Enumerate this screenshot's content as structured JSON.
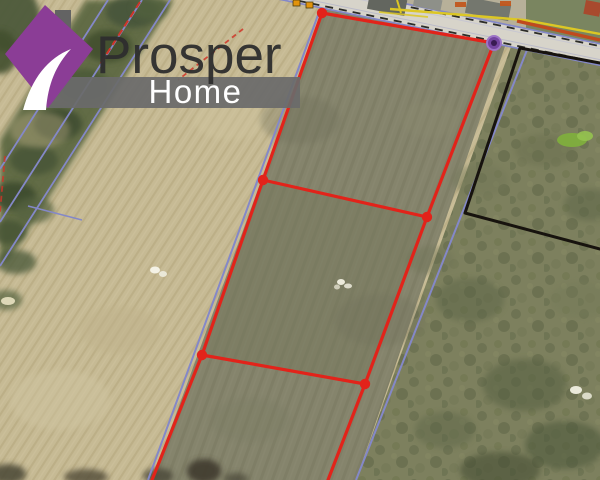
{
  "branding": {
    "title": "Prosper",
    "subtitle": "Home",
    "colors": {
      "icon_purple": "#8b3d96",
      "icon_chimney_gray": "#636363",
      "icon_swoosh_white": "#ffffff",
      "banner_gray": "#6a6a6a",
      "title_text": "#2e2e2e",
      "subtitle_text": "#ffffff"
    }
  },
  "map": {
    "type": "aerial-parcel-map",
    "palette": {
      "field_tan": "#c6ba94",
      "parcel_olive": "#85846c",
      "scrub_green": "#7d805e",
      "hedge_green": "#5a6641",
      "road_gray": "#d7d4ca",
      "cadastral_blue": "#8488c8",
      "parcel_red": "#e2231a",
      "parcel_black": "#17130e",
      "marker_orange": "#e2930c",
      "label_orange": "#c1571d",
      "line_yellow": "#dcc724",
      "line_orange": "#c04a1e",
      "marker_purple": "#7445a0"
    },
    "regions": [
      {
        "n": "base-farm-field",
        "p": [
          [
            0,
            0
          ],
          [
            600,
            0
          ],
          [
            600,
            480
          ],
          [
            0,
            480
          ]
        ],
        "f": "#c6ba94",
        "pat": "plow"
      },
      {
        "n": "listed-parcel-strip",
        "p": [
          [
            327,
            0
          ],
          [
            521,
            0
          ],
          [
            356,
            480
          ],
          [
            152,
            480
          ]
        ],
        "f": "#85846c",
        "pat": "mow"
      },
      {
        "n": "middle-subparcel-tint",
        "p": [
          [
            263,
            180
          ],
          [
            427,
            217
          ],
          [
            365,
            384
          ],
          [
            202,
            355
          ]
        ],
        "f": "#75785c",
        "o": 0.45
      },
      {
        "n": "scrub-field-east",
        "p": [
          [
            512,
            44
          ],
          [
            600,
            61
          ],
          [
            600,
            480
          ],
          [
            356,
            480
          ]
        ],
        "f": "#7d805e",
        "pat": "scrub"
      },
      {
        "n": "north-roadside-yard",
        "p": [
          [
            358,
            0
          ],
          [
            600,
            0
          ],
          [
            600,
            47
          ],
          [
            362,
            1
          ]
        ],
        "f": "#b7b099"
      },
      {
        "n": "north-roadside-grass",
        "p": [
          [
            526,
            0
          ],
          [
            600,
            0
          ],
          [
            600,
            47
          ],
          [
            526,
            33
          ]
        ],
        "f": "#7a8560"
      },
      {
        "n": "hedgerow-band",
        "p": [
          [
            86,
            0
          ],
          [
            174,
            0
          ],
          [
            8,
            262
          ],
          [
            0,
            262
          ],
          [
            0,
            140
          ]
        ],
        "f": "#5a6641",
        "o": 0.92,
        "blur": 1
      }
    ],
    "spots": [
      [
        10,
        18,
        30,
        34,
        "#4d5a3b",
        0.95,
        1
      ],
      [
        0,
        52,
        18,
        22,
        "#43502f",
        0.9,
        1
      ],
      [
        132,
        12,
        26,
        16,
        "#47553a",
        0.9,
        1
      ],
      [
        108,
        46,
        24,
        16,
        "#42502f",
        0.9,
        1
      ],
      [
        84,
        86,
        26,
        17,
        "#4c5a38",
        0.9,
        1
      ],
      [
        58,
        124,
        24,
        16,
        "#3f4d31",
        0.9,
        1
      ],
      [
        34,
        160,
        24,
        15,
        "#485638",
        0.9,
        1
      ],
      [
        14,
        196,
        22,
        14,
        "#3d4b2f",
        0.9,
        1
      ],
      [
        34,
        210,
        20,
        13,
        "#546241",
        0.7,
        1
      ],
      [
        8,
        232,
        18,
        12,
        "#465436",
        0.85,
        1
      ],
      [
        16,
        262,
        20,
        12,
        "#4f5d3d",
        0.8,
        1
      ],
      [
        6,
        300,
        16,
        10,
        "#556341",
        0.7,
        1
      ],
      [
        150,
        8,
        18,
        12,
        "#51603c",
        0.8,
        1
      ],
      [
        60,
        400,
        50,
        30,
        "#cfc4a0",
        0.5,
        1
      ],
      [
        120,
        330,
        40,
        24,
        "#bfb28b",
        0.5,
        1
      ],
      [
        230,
        120,
        36,
        20,
        "#cfc49e",
        0.45,
        1
      ],
      [
        40,
        130,
        30,
        18,
        "#b9ac84",
        0.4,
        1
      ],
      [
        300,
        120,
        40,
        24,
        "#6f705a",
        0.35,
        1
      ],
      [
        380,
        320,
        46,
        26,
        "#6f705a",
        0.3,
        1
      ],
      [
        250,
        420,
        40,
        22,
        "#7a7b63",
        0.35,
        1
      ],
      [
        430,
        120,
        30,
        18,
        "#8b8a70",
        0.35,
        1
      ],
      [
        470,
        300,
        34,
        22,
        "#5c6547",
        0.5,
        1
      ],
      [
        525,
        385,
        42,
        26,
        "#566042",
        0.55,
        1
      ],
      [
        565,
        445,
        40,
        24,
        "#4f5a3d",
        0.6,
        1
      ],
      [
        590,
        205,
        26,
        16,
        "#5c6547",
        0.5,
        1
      ],
      [
        445,
        430,
        30,
        18,
        "#5c6547",
        0.45,
        1
      ],
      [
        545,
        150,
        30,
        16,
        "#6a7050",
        0.5,
        1
      ],
      [
        480,
        180,
        28,
        16,
        "#717656",
        0.45,
        1
      ],
      [
        430,
        260,
        24,
        14,
        "#6d7254",
        0.4,
        1
      ],
      [
        580,
        300,
        30,
        18,
        "#757a58",
        0.45,
        1
      ],
      [
        500,
        470,
        40,
        18,
        "#474f35",
        0.6,
        1
      ],
      [
        8,
        474,
        18,
        10,
        "#4a4636",
        0.85,
        1
      ],
      [
        86,
        477,
        22,
        8,
        "#514b38",
        0.8,
        1
      ],
      [
        158,
        476,
        15,
        8,
        "#4a4637",
        0.8,
        1
      ],
      [
        204,
        471,
        17,
        12,
        "#3f3b2d",
        0.9,
        1
      ],
      [
        236,
        479,
        12,
        6,
        "#4a4637",
        0.7,
        1
      ],
      [
        572,
        140,
        15,
        7,
        "#7fae3d",
        0.95,
        0
      ],
      [
        585,
        136,
        8,
        5,
        "#95c24f",
        0.9,
        0
      ],
      [
        155,
        270,
        5,
        3.5,
        "#f4f2e6",
        1,
        0
      ],
      [
        163,
        274,
        4,
        3,
        "#eceadb",
        0.95,
        0
      ],
      [
        341,
        282,
        4,
        3,
        "#f2f0e2",
        0.95,
        0
      ],
      [
        348,
        286,
        4,
        2.5,
        "#e8e6d6",
        0.9,
        0
      ],
      [
        337,
        287,
        3,
        2.5,
        "#dcd9c8",
        0.85,
        0
      ],
      [
        576,
        390,
        6,
        4,
        "#f1efe2",
        0.95,
        0
      ],
      [
        587,
        396,
        5,
        3.5,
        "#e6e4d4",
        0.9,
        0
      ],
      [
        8,
        301,
        7,
        4,
        "#e9e2c2",
        0.9,
        0
      ]
    ],
    "road": {
      "a": [
        272,
        -13
      ],
      "b": [
        612,
        57
      ],
      "w": 21,
      "surface": "#d7d4ca",
      "edges": [
        {
          "o": -10.5,
          "c": "#8488c8",
          "w": 1.7
        },
        {
          "o": -8.2,
          "c": "#2c2c28",
          "w": 1.8,
          "d": "8,6"
        },
        {
          "o": 10.5,
          "c": "#8488c8",
          "w": 1.7
        },
        {
          "o": 8.2,
          "c": "#2c2c28",
          "w": 1.8,
          "d": "8,6"
        },
        {
          "o": -5.5,
          "c": "#b9bad8",
          "w": 1,
          "op": 0.5
        },
        {
          "o": 5,
          "c": "#9b9ec9",
          "w": 1,
          "op": 0.45
        }
      ]
    },
    "buildings": [
      {
        "x": 370,
        "y": -7,
        "w": 38,
        "h": 16,
        "f": "#63665f",
        "r": 11
      },
      {
        "x": 415,
        "y": -5,
        "w": 28,
        "h": 11,
        "f": "#8e9089",
        "r": 11
      },
      {
        "x": 468,
        "y": -3,
        "w": 44,
        "h": 16,
        "f": "#74776e",
        "r": 11
      },
      {
        "x": 586,
        "y": 0,
        "w": 16,
        "h": 14,
        "f": "#a84a2e",
        "r": 11
      }
    ],
    "lines": [
      {
        "n": "utility-line-yellow",
        "p": [
          [
            390,
            9
          ],
          [
            452,
            14
          ],
          [
            524,
            20
          ],
          [
            600,
            34
          ]
        ],
        "c": "#dcc724",
        "w": 2.4
      },
      {
        "n": "utility-line-yellow",
        "p": [
          [
            397,
            0
          ],
          [
            401,
            13
          ]
        ],
        "c": "#dcc724",
        "w": 2
      },
      {
        "n": "utility-line-yellow",
        "p": [
          [
            379,
            12
          ],
          [
            428,
            17
          ]
        ],
        "c": "#dcc724",
        "w": 1.8,
        "o": 0.85
      },
      {
        "n": "roadside-line-orange",
        "p": [
          [
            517,
            21
          ],
          [
            600,
            40
          ]
        ],
        "c": "#c04a1e",
        "w": 3.4
      },
      {
        "n": "cadastral-line-blue",
        "p": [
          [
            318,
            15
          ],
          [
            148,
            480
          ]
        ],
        "c": "#8488c8",
        "w": 2
      },
      {
        "n": "cadastral-line-blue",
        "p": [
          [
            527,
            50
          ],
          [
            356,
            480
          ]
        ],
        "c": "#8488c8",
        "w": 2
      },
      {
        "n": "cadastral-line-blue",
        "p": [
          [
            108,
            0
          ],
          [
            0,
            169
          ]
        ],
        "c": "#8488c8",
        "w": 1.8
      },
      {
        "n": "cadastral-line-blue",
        "p": [
          [
            142,
            0
          ],
          [
            0,
            222
          ]
        ],
        "c": "#8488c8",
        "w": 1.8
      },
      {
        "n": "cadastral-line-blue",
        "p": [
          [
            28,
            206
          ],
          [
            82,
            220
          ]
        ],
        "c": "#8488c8",
        "w": 1.5
      },
      {
        "n": "cadastral-line-blue",
        "p": [
          [
            170,
            0
          ],
          [
            0,
            266
          ]
        ],
        "c": "#8488c8",
        "w": 1.8
      },
      {
        "n": "cadastral-line-red",
        "p": [
          [
            140,
            2
          ],
          [
            99,
            66
          ]
        ],
        "c": "#cf3528",
        "w": 2,
        "d": "7,4"
      },
      {
        "n": "cadastral-line-red",
        "p": [
          [
            243,
            29
          ],
          [
            178,
            80
          ]
        ],
        "c": "#cf3528",
        "w": 1.8,
        "d": "5,4",
        "o": 0.85
      },
      {
        "n": "cadastral-line-red",
        "p": [
          [
            5,
            156
          ],
          [
            0,
            212
          ]
        ],
        "c": "#cf3528",
        "w": 1.8,
        "d": "6,4",
        "o": 0.8
      }
    ],
    "road_markers": [
      [
        293,
        0
      ],
      [
        306,
        2
      ]
    ],
    "orange_labels": [
      [
        455,
        2
      ],
      [
        500,
        1
      ]
    ],
    "parcels": [
      {
        "id": "neighbor-parcel-black",
        "color": "#17130e",
        "w": 3,
        "closed": false,
        "outline": [
          [
            600,
            63
          ],
          [
            520,
            48
          ],
          [
            465,
            213
          ],
          [
            600,
            249
          ]
        ]
      },
      {
        "id": "listed-parcel-red",
        "color": "#e2231a",
        "w": 3.2,
        "closed": false,
        "dot_r": 5.2,
        "outline": [
          [
            328,
            480
          ],
          [
            365,
            384
          ],
          [
            427,
            217
          ],
          [
            494,
            43
          ],
          [
            322,
            13
          ],
          [
            263,
            180
          ],
          [
            202,
            355
          ],
          [
            152,
            480
          ]
        ],
        "dividers": [
          [
            [
              263,
              180
            ],
            [
              427,
              217
            ]
          ],
          [
            [
              202,
              355
            ],
            [
              365,
              384
            ]
          ]
        ],
        "vertices": [
          [
            322,
            13
          ],
          [
            263,
            180
          ],
          [
            427,
            217
          ],
          [
            202,
            355
          ],
          [
            365,
            384
          ]
        ]
      }
    ],
    "marker": {
      "shape": "circle",
      "x": 494,
      "y": 43,
      "r": 7,
      "inner_r": 3,
      "fill": "#7445a0",
      "ring": "#9d74c6",
      "inner": "#381b52"
    }
  }
}
